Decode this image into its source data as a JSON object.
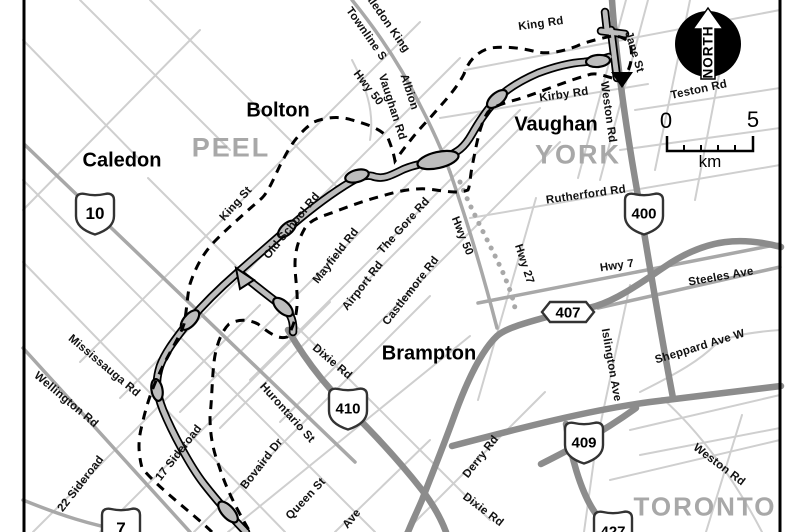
{
  "map": {
    "regions": {
      "peel": "PEEL",
      "york": "YORK",
      "toronto": "TORONTO"
    },
    "cities": {
      "caledon": "Caledon",
      "bolton": "Bolton",
      "vaughan": "Vaughan",
      "brampton": "Brampton"
    },
    "roads": {
      "king_rd": "King Rd",
      "kirby_rd": "Kirby Rd",
      "jane_st": "Jane St",
      "weston_rd_north": "Weston Rd",
      "teston_rd": "Teston Rd",
      "rutherford_rd": "Rutherford Rd",
      "hwy_7": "Hwy 7",
      "steeles_ave": "Steeles Ave",
      "sheppard_ave_w": "Sheppard Ave W",
      "islington_ave": "Islington Ave",
      "weston_rd_south": "Weston Rd",
      "derry_rd": "Derry Rd",
      "dixie_rd_north": "Dixie Rd",
      "dixie_rd_south": "Dixie Rd",
      "hurontario_st": "Hurontario St",
      "queen_st": "Queen St",
      "bovaird_dr": "Bovaird Dr",
      "sideroad_17": "17 Sideroad",
      "sideroad_22": "22 Sideroad",
      "wellington_rd": "Wellington Rd",
      "mississauga_rd": "Mississauga Rd",
      "old_school_rd": "Old School Rd",
      "king_st": "King St",
      "mayfield_rd": "Mayfield Rd",
      "airport_rd": "Airport Rd",
      "castlemore_rd": "Castlemore Rd",
      "the_gore_rd": "The Gore Rd",
      "hwy_50_north": "Hwy 50",
      "hwy_50_mid": "Hwy 50",
      "hwy_27": "Hwy 27",
      "albion_line1": "Albion",
      "albion_line2": "Vaughan Rd",
      "caledon_king_line1": "Caledon King",
      "caledon_king_line2": "Townline S",
      "ave_partial": "Ave"
    },
    "shields": {
      "hwy_10": "10",
      "hwy_410": "410",
      "hwy_400": "400",
      "hwy_409": "409",
      "hwy_427": "427",
      "hwy_7_shield": "7",
      "hwy_407": "407"
    },
    "north_badge": {
      "label": "NORTH"
    },
    "scale_bar": {
      "start": "0",
      "end": "5",
      "unit": "km"
    },
    "colors": {
      "minor_road": "#cfcfcf",
      "arterial_road": "#a8a8a8",
      "highway": "#8c8c8c",
      "corridor_fill": "#bdbdbd",
      "boundary": "#000000",
      "region_label": "#a8a8a8"
    }
  }
}
